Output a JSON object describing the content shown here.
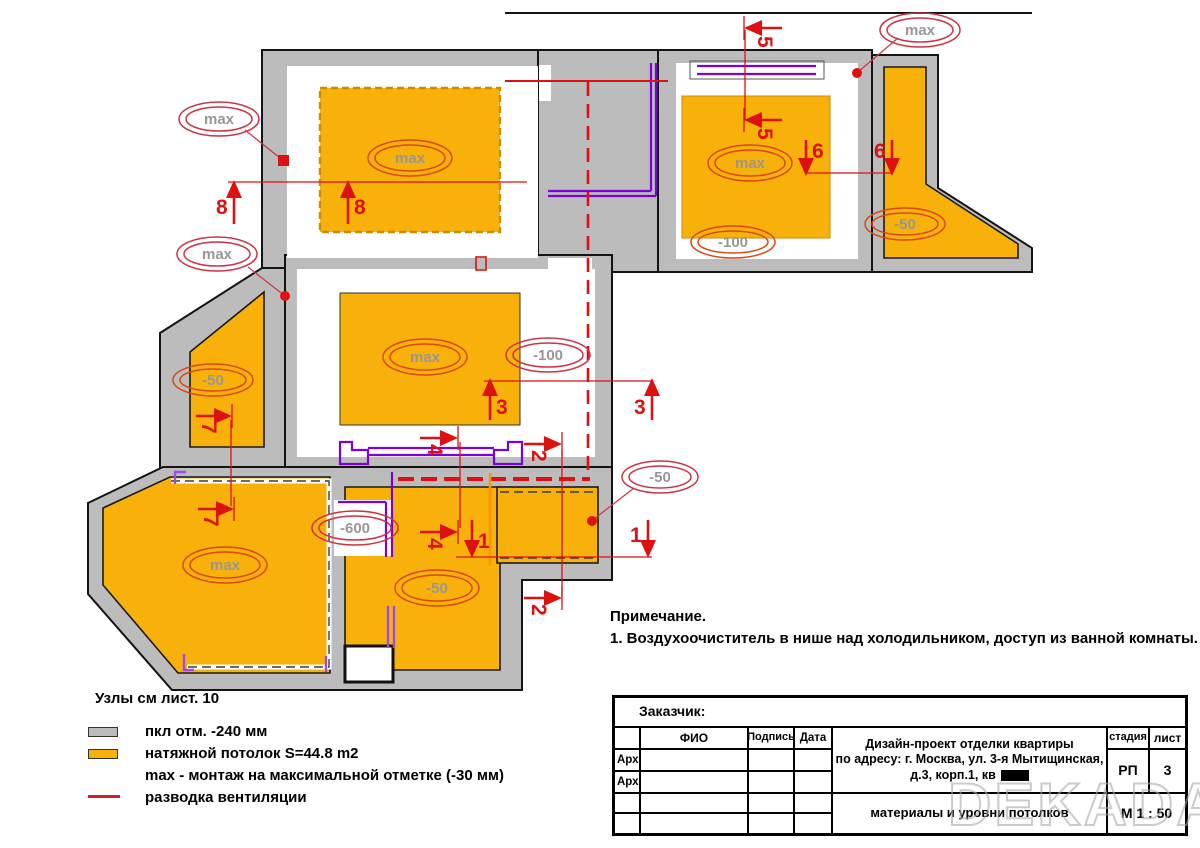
{
  "plan": {
    "ellipse_labels": [
      {
        "text": "max"
      },
      {
        "text": "max"
      },
      {
        "text": "max"
      },
      {
        "text": "max"
      },
      {
        "text": "max"
      },
      {
        "text": "-100"
      },
      {
        "text": "-50"
      },
      {
        "text": "max"
      },
      {
        "text": "-100"
      },
      {
        "text": "-50"
      },
      {
        "text": "-50"
      },
      {
        "text": "-600"
      },
      {
        "text": "max"
      },
      {
        "text": "-50"
      }
    ],
    "section_marks": [
      {
        "n": "8"
      },
      {
        "n": "8"
      },
      {
        "n": "5"
      },
      {
        "n": "5"
      },
      {
        "n": "6"
      },
      {
        "n": "6"
      },
      {
        "n": "3"
      },
      {
        "n": "3"
      },
      {
        "n": "7"
      },
      {
        "n": "7"
      },
      {
        "n": "4"
      },
      {
        "n": "4"
      },
      {
        "n": "1"
      },
      {
        "n": "1"
      },
      {
        "n": "2"
      },
      {
        "n": "2"
      }
    ]
  },
  "legend": {
    "nodes_note": "Узлы см  лист. 10",
    "items": [
      {
        "label": "пкл отм. -240 мм"
      },
      {
        "label": "натяжной потолок S=44.8 m2"
      },
      {
        "label": "max - монтаж на максимальной отметке (-30 мм)"
      },
      {
        "label": "разводка вентиляции"
      }
    ]
  },
  "note": {
    "title": "Примечание.",
    "line1": "1. Воздухоочиститель в нише над холодильником, доступ из ванной комнаты."
  },
  "title_block": {
    "customer_label": "Заказчик:",
    "col_fio": "ФИО",
    "col_podpis": "Подпись",
    "col_data": "Дата",
    "row_arch1": "Арх.",
    "row_arch2": "Арх.",
    "project_line1": "Дизайн-проект отделки квартиры",
    "project_line2": "по адресу: г. Москва, ул. 3-я Мытищинская,",
    "project_line3": "д.3, корп.1, кв",
    "stage_label": "стадия",
    "sheet_label": "лист",
    "stage_value": "РП",
    "sheet_value": "3",
    "doc_title": "материалы и уровни потолков",
    "scale": "М 1 : 50"
  },
  "watermark": "DEKADA",
  "colors": {
    "ceiling_orange": "#F7B10A",
    "wall_gray": "#BCBCBC",
    "vent_red": "#DD1111",
    "niche_purple": "#7A00DD",
    "label_gray": "#979797",
    "ellipse_red": "#CC3344"
  }
}
